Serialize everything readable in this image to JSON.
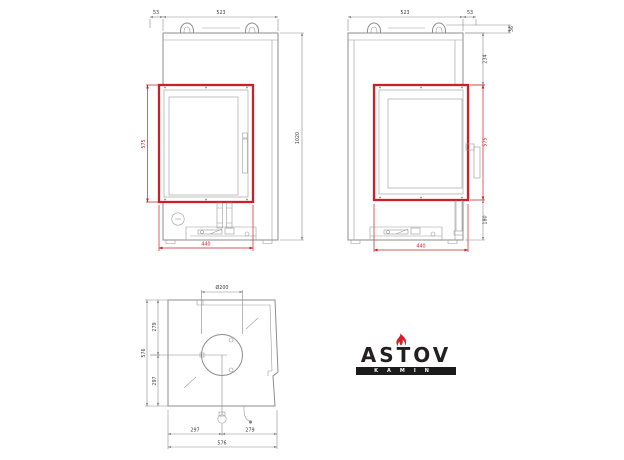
{
  "brand": {
    "name": "ASTOV",
    "sub": "KAMIN",
    "flame_color": "#d2232a",
    "bar_color": "#1b1b1b"
  },
  "colors": {
    "drawing_line": "#8d8d8d",
    "accent_red": "#c9202a",
    "dim_text": "#3c3c3c"
  },
  "front_view": {
    "dims": {
      "offset_top": "53",
      "width_top": "523",
      "height_total": "1020",
      "door_height": "575",
      "width_bottom": "440"
    }
  },
  "side_view": {
    "dims": {
      "width_top": "523",
      "offset_top": "53",
      "collar_height": "36",
      "top_to_door": "234",
      "door_height": "575",
      "base_height": "180",
      "width_bottom": "440"
    }
  },
  "top_view": {
    "dims": {
      "flue": "Ø200",
      "left_upper": "279",
      "left_total": "576",
      "left_lower": "297",
      "bottom_left": "297",
      "bottom_right": "279",
      "bottom_total": "576"
    }
  }
}
